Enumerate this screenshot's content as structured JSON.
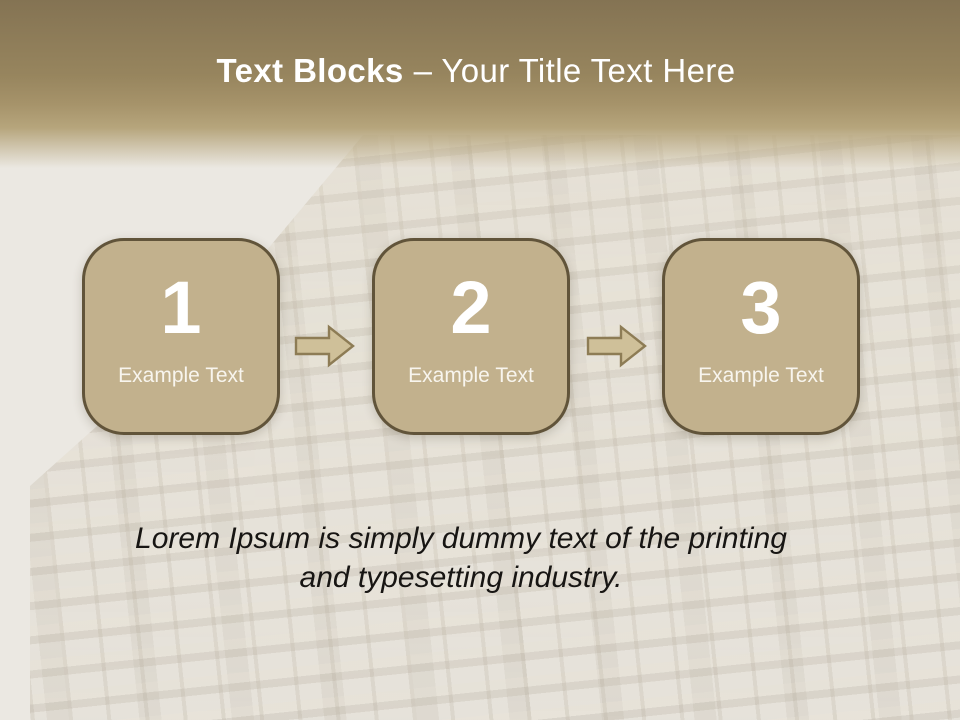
{
  "theme": {
    "page-bg": "#ebe8e2",
    "band-top": "#847353",
    "band-mid": "#a6936a",
    "band-low": "#b6a57c",
    "title-color": "#ffffff",
    "block-fill": "#c2b18d",
    "block-border": "#61543a",
    "block-text": "#f8f5ee",
    "arrow-fill": "#cfc099",
    "arrow-stroke": "#8d7c55",
    "caption-color": "#171513"
  },
  "title": {
    "bold": "Text Blocks",
    "rest": "– Your Title Text Here"
  },
  "blocks": [
    {
      "number": "1",
      "label": "Example Text"
    },
    {
      "number": "2",
      "label": "Example Text"
    },
    {
      "number": "3",
      "label": "Example Text"
    }
  ],
  "arrows": [
    {
      "icon": "arrow-right-icon"
    },
    {
      "icon": "arrow-right-icon"
    }
  ],
  "caption": {
    "line1": "Lorem Ipsum is simply dummy text of the printing",
    "line2": "and typesetting industry."
  }
}
